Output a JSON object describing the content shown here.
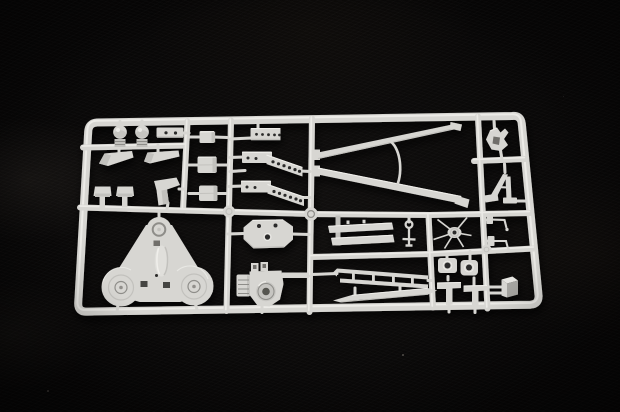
{
  "scene": {
    "type": "photograph",
    "subject": "injection-moulded plastic model kit sprue with unpainted light grey parts",
    "setting": "sprue lying on a black fabric background, lit from the upper left",
    "orientation": "sprue nearly fills the frame, tilted slightly with mild camera perspective"
  },
  "colors": {
    "bg": "#070606",
    "base": "#d7d6d2",
    "light": "#f0efeb",
    "mid": "#c2c1bd",
    "dark": "#a7a6a2",
    "edge": "#8e8d89",
    "hole": "#2c2b29",
    "recess": "#c6c5c1",
    "notch": "#6f6e6a"
  },
  "sprue": {
    "frame": {
      "shape": "rounded rectangle",
      "corner_radius_px": 9
    },
    "runners": {
      "vertical": 5,
      "horizontal": 4
    },
    "parts": [
      {
        "id": "dome-post",
        "label": "round-headed post",
        "count": 2
      },
      {
        "id": "twin-hole-plate",
        "label": "flat plate with two holes",
        "count": 1
      },
      {
        "id": "wing-blade",
        "label": "angled wing blade",
        "count": 2
      },
      {
        "id": "mushroom-post",
        "label": "mushroom-cap post",
        "count": 2
      },
      {
        "id": "angled-bracket-plate",
        "label": "angled flat bracket",
        "count": 1
      },
      {
        "id": "stowage-box",
        "label": "rectangular box",
        "count": 3
      },
      {
        "id": "perforated-strip",
        "label": "strip with five holes",
        "count": 1
      },
      {
        "id": "perforated-walkway",
        "label": "bent walkway strip with six holes",
        "count": 2
      },
      {
        "id": "tapered-boom",
        "label": "long tapered boom strut",
        "count": 2
      },
      {
        "id": "curved-brace",
        "label": "curved wire brace",
        "count": 1
      },
      {
        "id": "eyelet-pin",
        "label": "eyelet pin with crossbar",
        "count": 1
      },
      {
        "id": "plank",
        "label": "flat plank with locating pins",
        "count": 2
      },
      {
        "id": "spoked-hub",
        "label": "small spoked hub",
        "count": 1
      },
      {
        "id": "tri-base",
        "label": "triangular base plate with three round bosses",
        "count": 1
      },
      {
        "id": "octagon-plate",
        "label": "octagonal plate with three holes",
        "count": 1
      },
      {
        "id": "mount-bracket",
        "label": "mount bracket with round recess and finned block",
        "count": 1
      },
      {
        "id": "handrail",
        "label": "handrail with four posts",
        "count": 1
      },
      {
        "id": "skid-blade",
        "label": "long tapered skid blade",
        "count": 1
      },
      {
        "id": "drilled-pad",
        "label": "small pad with centre hole",
        "count": 2
      },
      {
        "id": "t-hanger",
        "label": "T-shaped hanger",
        "count": 2
      },
      {
        "id": "crank-pin",
        "label": "bent crank pin",
        "count": 2
      },
      {
        "id": "gear-block",
        "label": "small rectangular block",
        "count": 1
      },
      {
        "id": "notched-mount",
        "label": "notched mounting bracket",
        "count": 1
      },
      {
        "id": "a-frame-strut",
        "label": "A-frame support strut",
        "count": 1
      }
    ]
  }
}
